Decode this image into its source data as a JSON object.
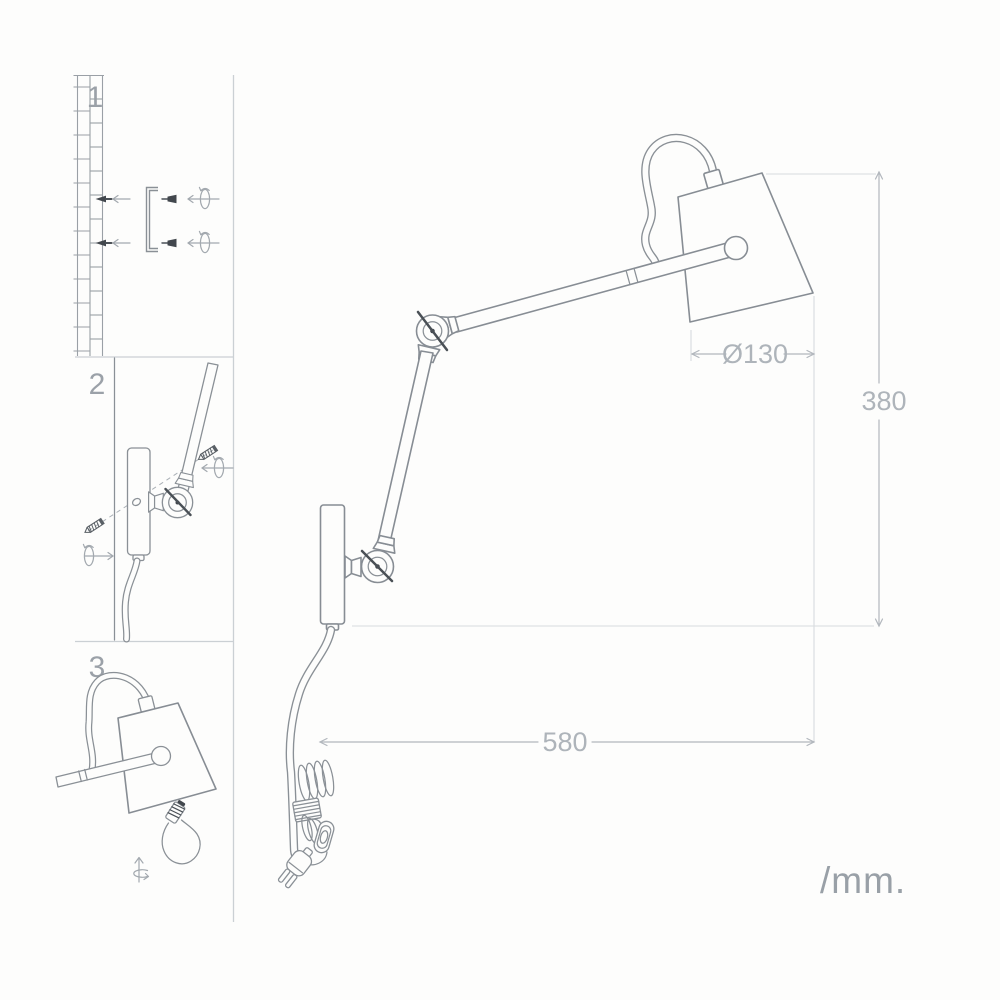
{
  "diagram": {
    "steps": [
      {
        "number": "1"
      },
      {
        "number": "2"
      },
      {
        "number": "3"
      }
    ],
    "dimensions": {
      "shade_diameter": "Ø130",
      "height": "380",
      "width": "580"
    },
    "units_label": "/mm.",
    "colors": {
      "line": "#878d94",
      "dimension": "#aeb4ba",
      "extension": "#d8dbde",
      "dark_accent": "#42474d",
      "panel_border": "#cbd0d4",
      "label": "#9ba1a8",
      "background": "#fdfdfc"
    }
  }
}
